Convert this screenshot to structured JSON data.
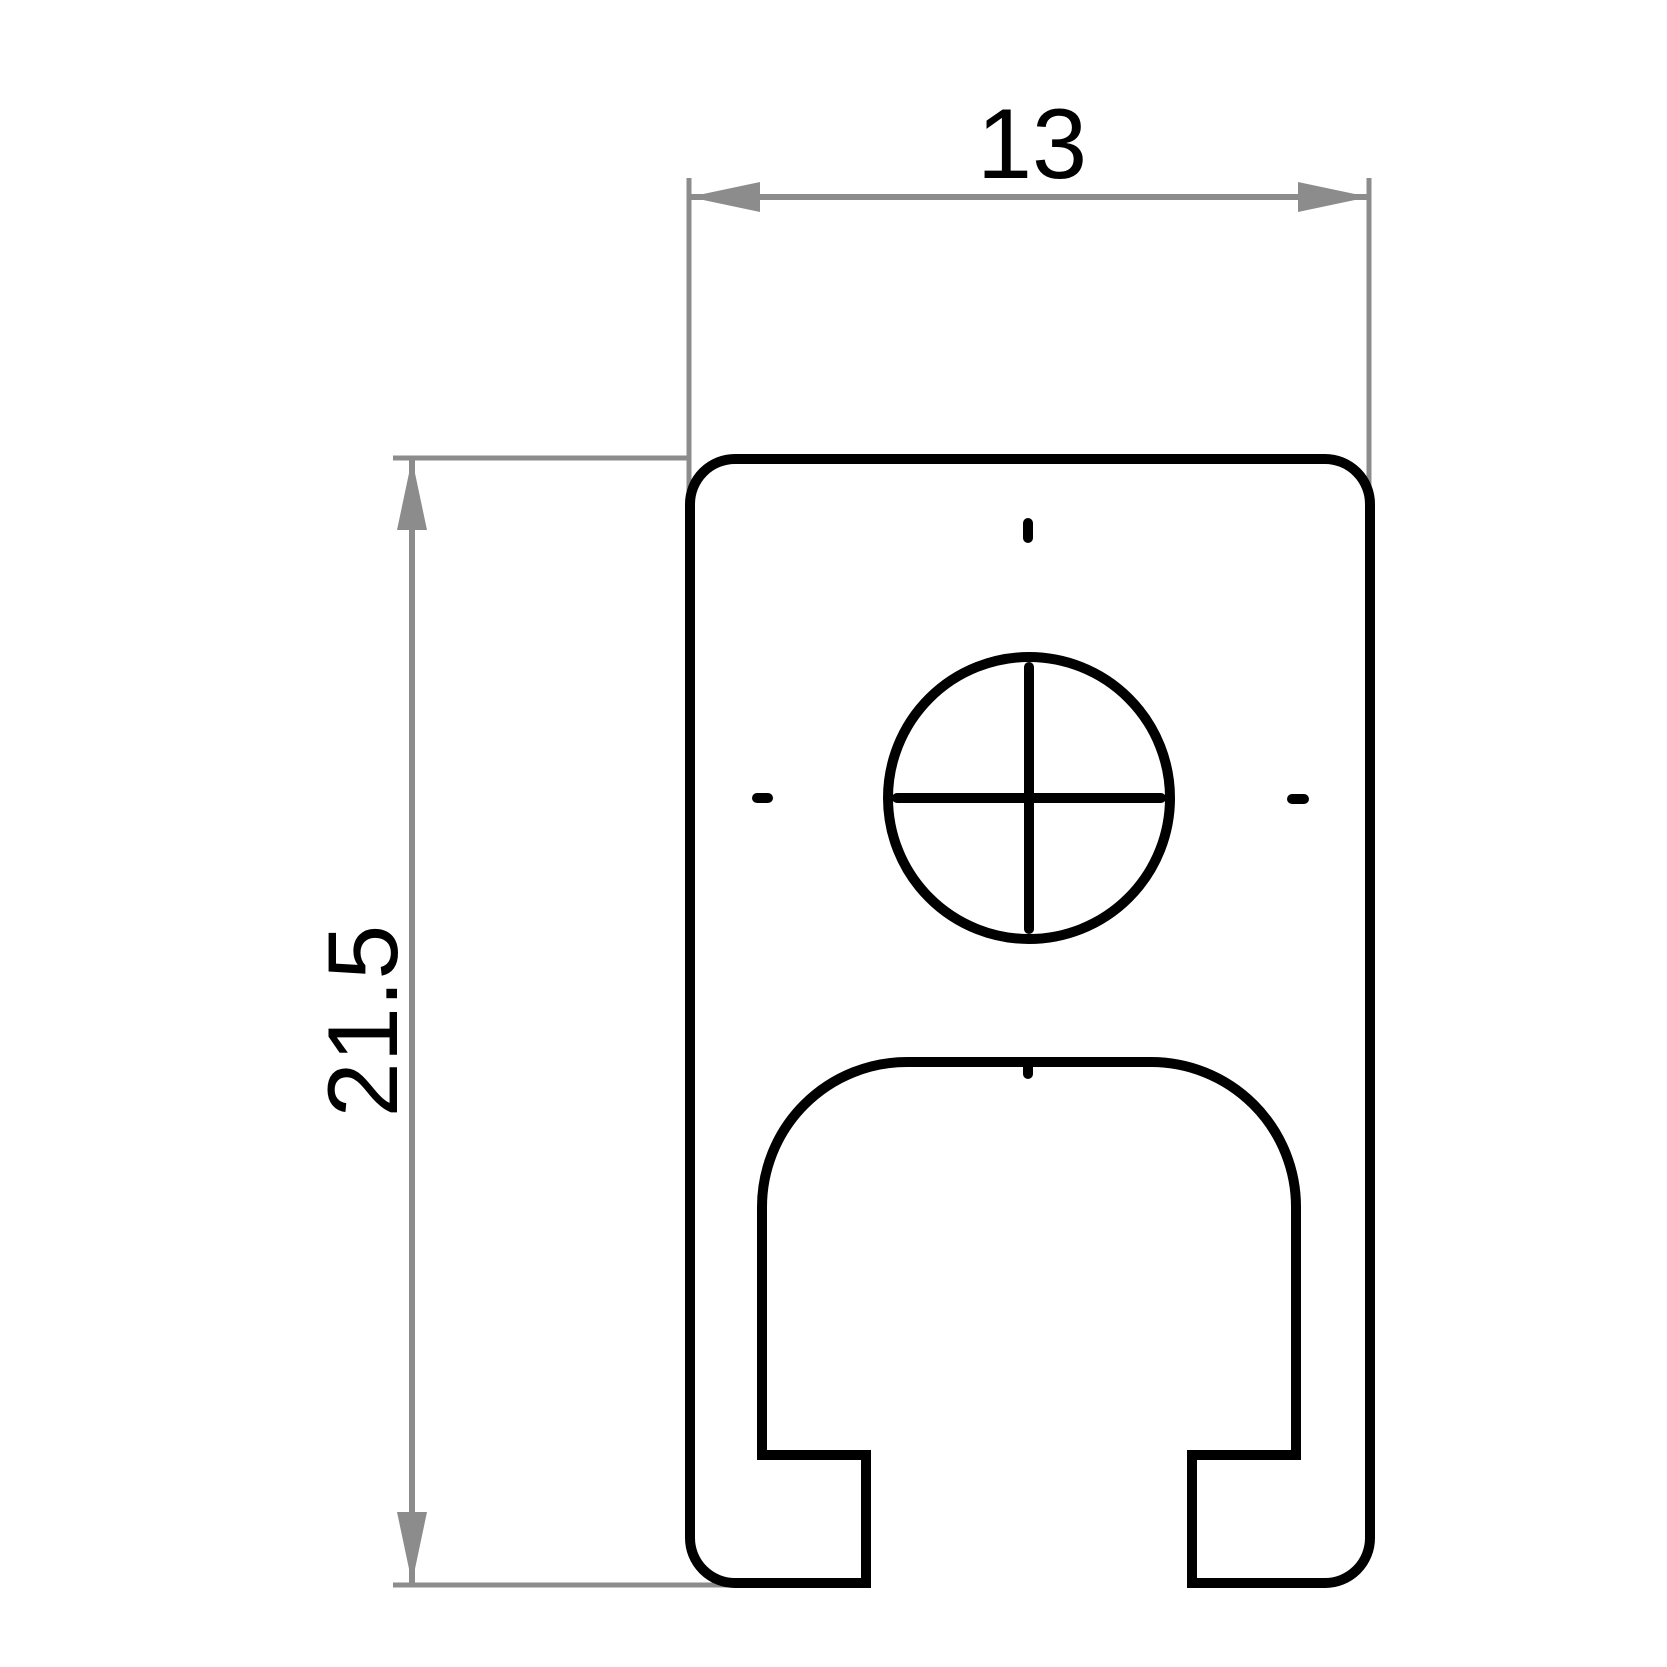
{
  "title": "Profile cross-section technical drawing",
  "colors": {
    "background": "#ffffff",
    "outline": "#000000",
    "dimension": "#8c8c8c",
    "text": "#000000"
  },
  "dimensions": {
    "width": {
      "label": "13"
    },
    "height": {
      "label": "21.5"
    }
  }
}
